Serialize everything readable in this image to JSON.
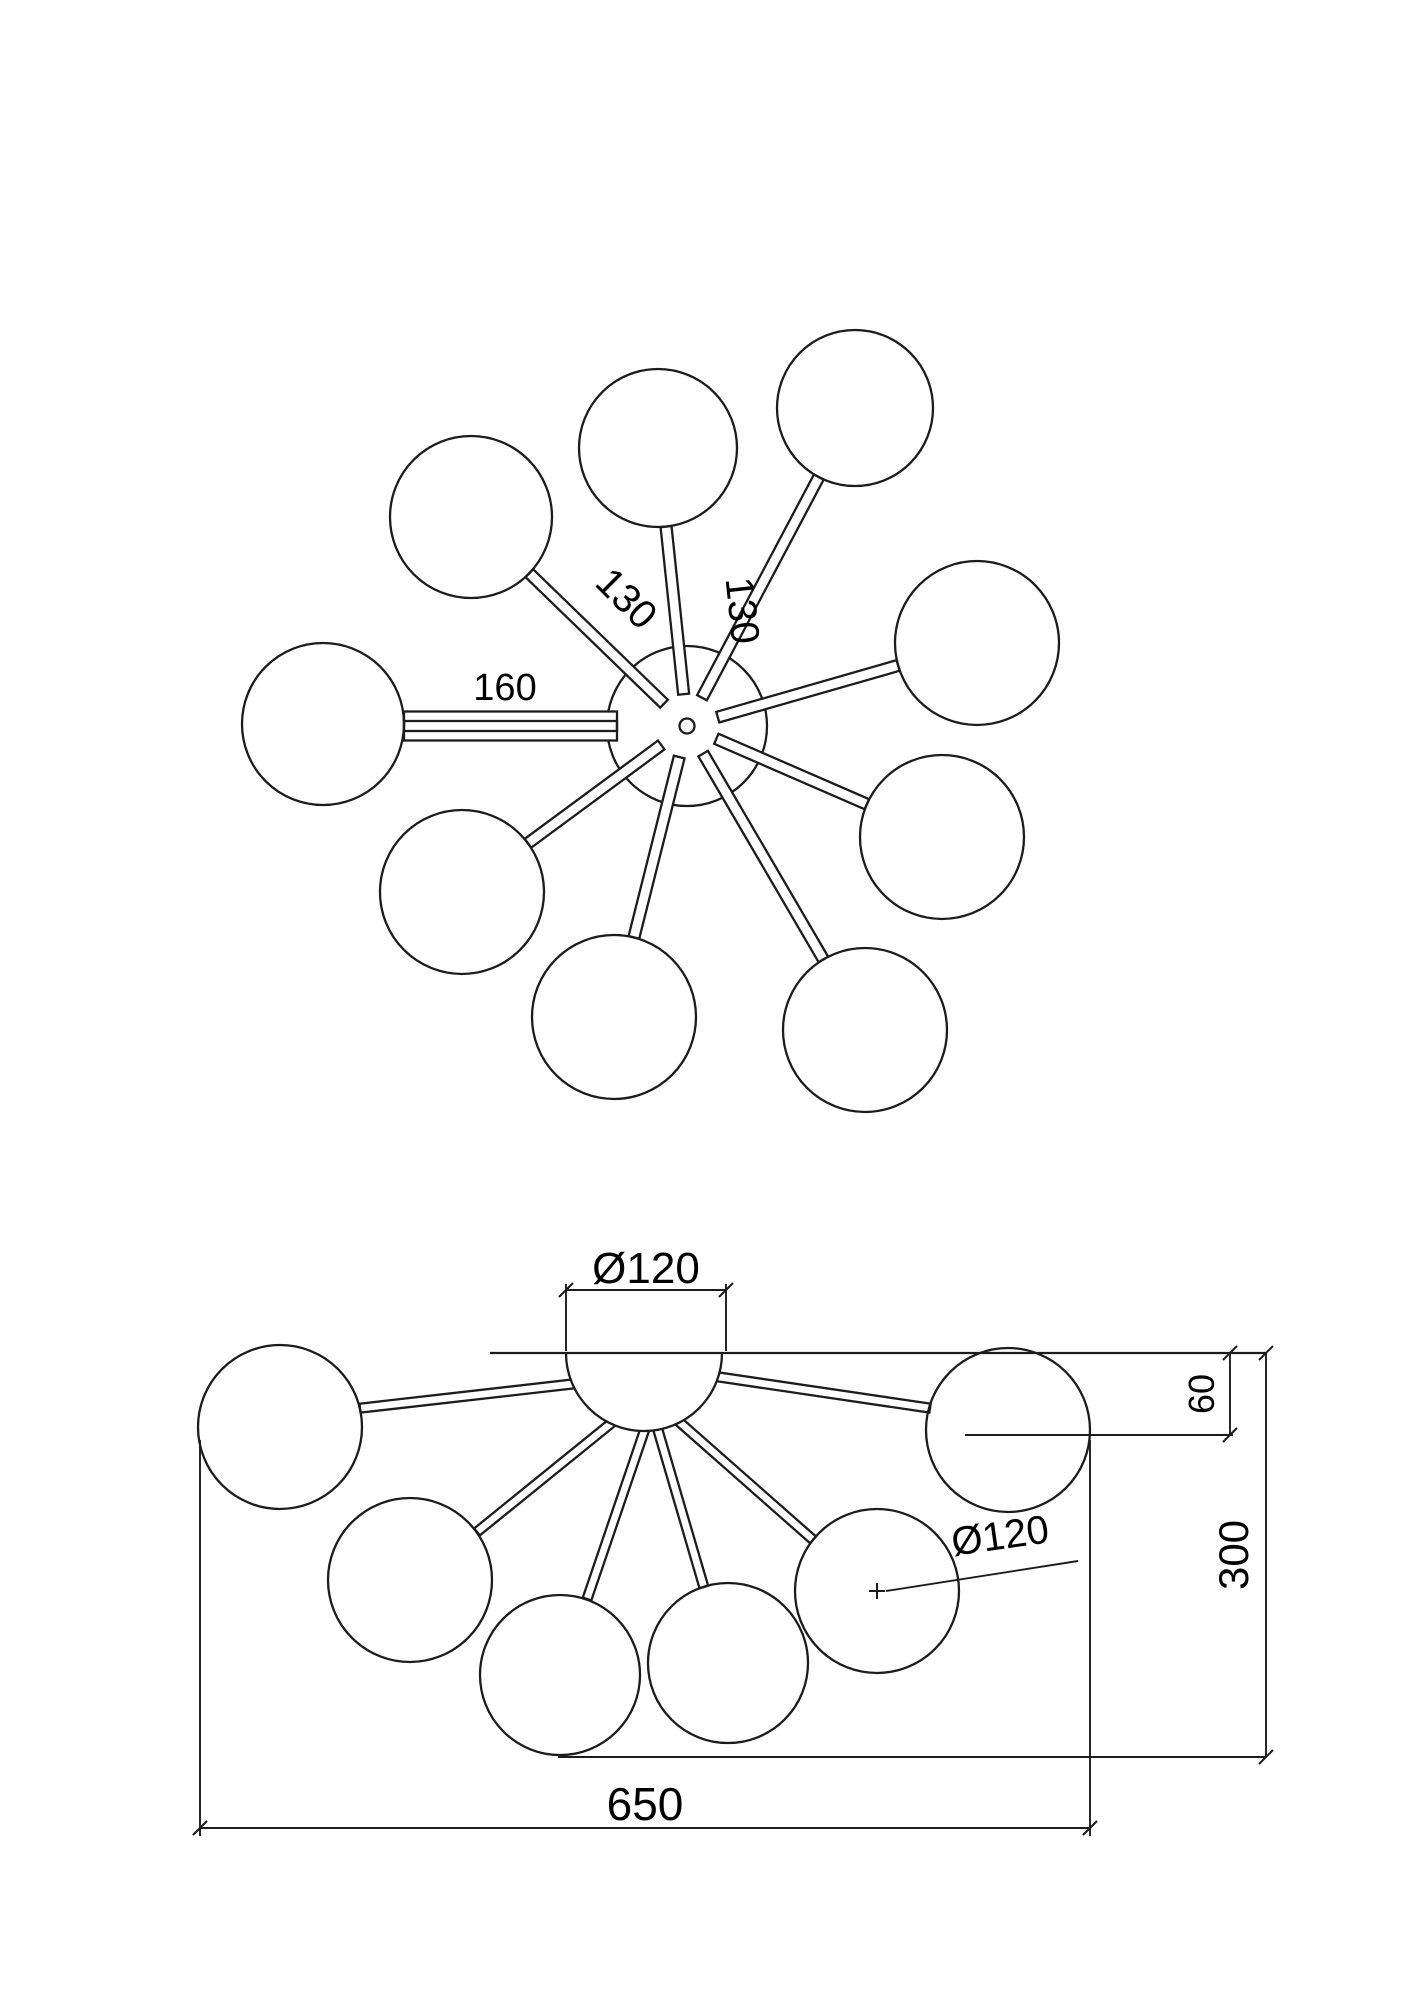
{
  "drawing": {
    "description": "Technical dimension drawing of a 9-light sputnik ceiling chandelier, top view and front view",
    "line_color": "#1c1c1c",
    "background_color": "#ffffff",
    "views": [
      "top view",
      "front view"
    ]
  },
  "top_view": {
    "labels": {
      "arm_nw_length": "130",
      "arm_n_length": "130",
      "arm_w_length": "160"
    },
    "globe_count": 9
  },
  "front_view": {
    "labels": {
      "canopy_diameter": "Ø120",
      "canopy_drop": "60",
      "overall_height": "300",
      "overall_width": "650",
      "shade_diameter": "Ø120"
    },
    "globe_count": 6
  },
  "dimensions_mm": {
    "arm_lengths": [
      "130",
      "130",
      "160"
    ],
    "canopy_diameter": "120",
    "canopy_drop": "60",
    "overall_height": "300",
    "overall_width": "650",
    "shade_diameter": "120"
  }
}
